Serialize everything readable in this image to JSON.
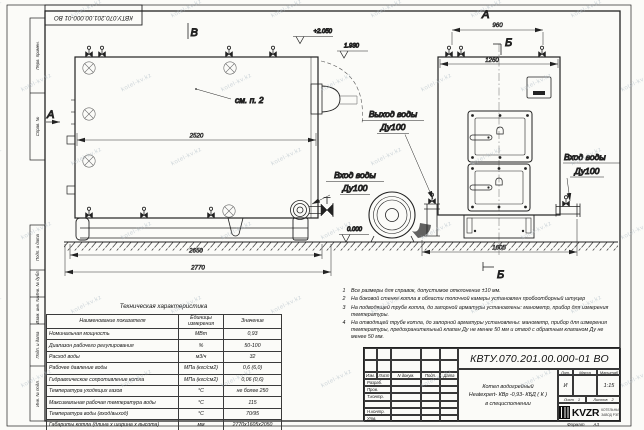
{
  "page": {
    "bg": "#fbfbf8",
    "line_color": "#222222",
    "watermark_color": "#a9b6c0",
    "logo_color": "#0d0d0d"
  },
  "watermark": "kotel-kv.kz",
  "doc": {
    "number": "КВТУ.070.201.00.000-01 ВО",
    "title_line1": "Котел водогрейный",
    "title_line2": "Heatexpert- КВр -0,93- КБД ( К )",
    "title_line3": "в специсполнении",
    "lit_label": "Лит.",
    "lit": "И",
    "mass_label": "Масса",
    "scale_label": "Масштаб",
    "scale": "1:15",
    "sheet_label": "Лист",
    "sheet": "1",
    "sheets_label": "Листов",
    "sheets": "2",
    "format_label": "Формат",
    "format_value": "А3",
    "logo": "KVZR",
    "logo_sub1": "КОТЕЛЬНЫЙ",
    "logo_sub2": "ЗАВОД РЭП"
  },
  "stamp": {
    "header": [
      "Изм.",
      "Лист",
      "N докум.",
      "Подп.",
      "Дата"
    ],
    "rows": [
      "Разраб.",
      "Пров.",
      "Т.контр.",
      "",
      "Н.контр.",
      "Утв."
    ]
  },
  "margin_labels": [
    "Перв. примен.",
    "Справ. №",
    "Подп. и дата",
    "Инв. № дубл.",
    "Взам. инв. №",
    "Подп. и дата",
    "Инв. № подл."
  ],
  "views": {
    "labels": {
      "v_top": "В",
      "a_left": "А",
      "a_top": "А",
      "b_top": "Б",
      "b_bottom": "Б"
    },
    "see_note": "см. п. 2",
    "elev_top": "+2.050",
    "elev_mid": "1.930",
    "elev_zero": "0.000",
    "outlet_label": [
      "Выход воды",
      "Ду100"
    ],
    "inlet_label_left": [
      "Вход воды",
      "Ду100"
    ],
    "inlet_label_right": [
      "Вход воды",
      "Ду100"
    ],
    "dims": {
      "d2520": "2520",
      "d2650": "2650",
      "d2770": "2770",
      "d960": "960",
      "d1260": "1260",
      "d1605": "1605"
    }
  },
  "tech_table": {
    "title": "Техническая характеристика",
    "headers": [
      "Наименование показателя",
      "Единицы измерения",
      "Значение"
    ],
    "rows": [
      [
        "Номинальная мощность",
        "МВт",
        "0,93"
      ],
      [
        "Диапазон рабочего регулирования",
        "%",
        "50-100"
      ],
      [
        "Расход воды",
        "м3/ч",
        "32"
      ],
      [
        "Рабочее давление воды",
        "МПа (кгс/см2)",
        "0,6 (6,0)"
      ],
      [
        "Гидравлическое сопротивление котла",
        "МПа (кгс/см2)",
        "0,06 (0,6)"
      ],
      [
        "Температура уходящих газов",
        "°С",
        "не более 250"
      ],
      [
        "Максимальная рабочая температура воды",
        "°С",
        "115"
      ],
      [
        "Температура воды (вход/выход)",
        "°С",
        "70/95"
      ],
      [
        "Габариты котла (длина х ширина х высота)",
        "мм",
        "2770х1605х2050"
      ]
    ]
  },
  "notes": [
    {
      "num": "1",
      "text": "Все размеры для справок, допустимое отклонение ±10 мм."
    },
    {
      "num": "2",
      "text": "На боковой стенке котла в области топочной камеры установлен пробоотборный штуцер"
    },
    {
      "num": "3",
      "text": "На подводящей трубе котла, до запорной арматуры установлены: манометр, прибор для измерения температуры."
    },
    {
      "num": "4",
      "text": "На отводящей трубе котла, до запорной арматуры установлены: манометр, прибор для измерения температуры, предохранительный клапан Ду не менее 50 мм и отвод с обратным клапаном Ду не менее 50 мм."
    }
  ]
}
